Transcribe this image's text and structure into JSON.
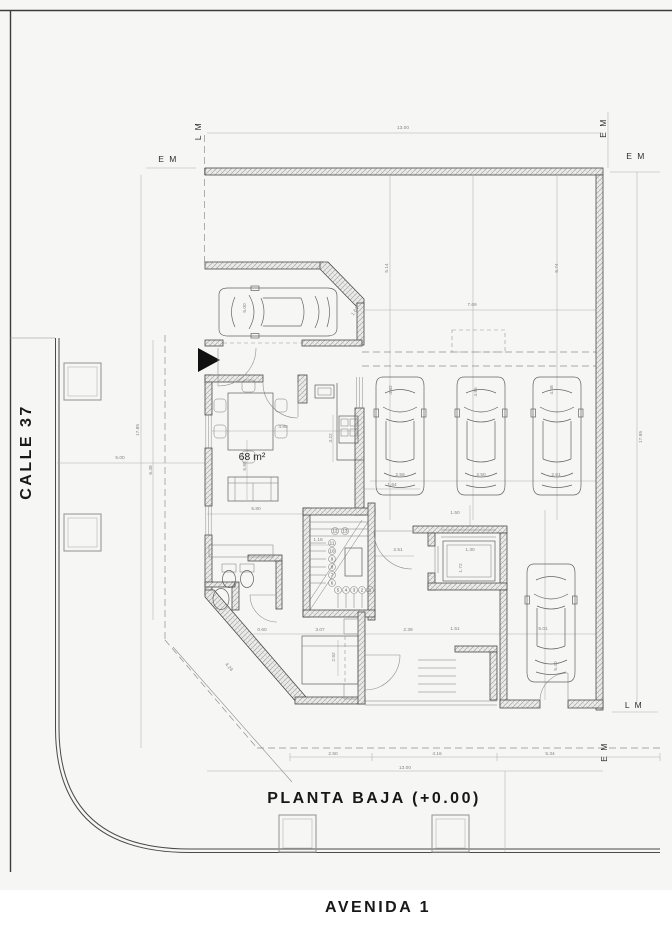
{
  "sheet": {
    "title": "PLANTA BAJA (+0.00)",
    "street_left": "CALLE 37",
    "street_bottom": "AVENIDA 1",
    "area_label": "68 m²"
  },
  "colors": {
    "paper": "#f6f6f4",
    "wall_line": "#4a4a4a",
    "dim_line": "#b0b0b0",
    "text": "#181818"
  },
  "markers": [
    {
      "text": "L M",
      "x": 201,
      "y": 131,
      "rot": -90
    },
    {
      "text": "E M",
      "x": 168,
      "y": 162
    },
    {
      "text": "E M",
      "x": 606,
      "y": 128,
      "rot": -90
    },
    {
      "text": "E M",
      "x": 636,
      "y": 159
    },
    {
      "text": "L M",
      "x": 634,
      "y": 708
    },
    {
      "text": "E M",
      "x": 607,
      "y": 752,
      "rot": -90
    }
  ],
  "dimensions": [
    {
      "text": "13.00",
      "x": 403,
      "y": 129
    },
    {
      "text": "17.95",
      "x": 642,
      "y": 437,
      "rot": -90
    },
    {
      "text": "17.85",
      "x": 139,
      "y": 430,
      "rot": -90
    },
    {
      "text": "6.49",
      "x": 152,
      "y": 470,
      "rot": -90
    },
    {
      "text": "5.00",
      "x": 120,
      "y": 459
    },
    {
      "text": "5.14",
      "x": 388,
      "y": 268,
      "rot": -90
    },
    {
      "text": "5.74",
      "x": 558,
      "y": 268,
      "rot": -90
    },
    {
      "text": "7.69",
      "x": 472,
      "y": 306
    },
    {
      "text": "4.92",
      "x": 392,
      "y": 390,
      "rot": -90
    },
    {
      "text": "4.95",
      "x": 477,
      "y": 392,
      "rot": -90
    },
    {
      "text": "4.68",
      "x": 553,
      "y": 390,
      "rot": -90
    },
    {
      "text": "2.59",
      "x": 400,
      "y": 476
    },
    {
      "text": "2.50",
      "x": 481,
      "y": 476
    },
    {
      "text": "2.61",
      "x": 556,
      "y": 476
    },
    {
      "text": "5.00",
      "x": 246,
      "y": 308,
      "rot": -90
    },
    {
      "text": "1.63",
      "x": 356,
      "y": 312,
      "rot": -55
    },
    {
      "text": "4.80",
      "x": 283,
      "y": 428
    },
    {
      "text": "3.22",
      "x": 332,
      "y": 438,
      "rot": -90
    },
    {
      "text": "5.98",
      "x": 246,
      "y": 466,
      "rot": -90
    },
    {
      "text": "5.80",
      "x": 256,
      "y": 510
    },
    {
      "text": "1.64",
      "x": 392,
      "y": 486
    },
    {
      "text": "1.18",
      "x": 318,
      "y": 541
    },
    {
      "text": "2.51",
      "x": 398,
      "y": 551
    },
    {
      "text": "1.50",
      "x": 455,
      "y": 514
    },
    {
      "text": "1.30",
      "x": 470,
      "y": 551
    },
    {
      "text": "1.72",
      "x": 462,
      "y": 568,
      "rot": -90
    },
    {
      "text": "0.60",
      "x": 262,
      "y": 631
    },
    {
      "text": "3.07",
      "x": 320,
      "y": 631
    },
    {
      "text": "2.92",
      "x": 335,
      "y": 657,
      "rot": -90
    },
    {
      "text": "2.39",
      "x": 408,
      "y": 631
    },
    {
      "text": "1.51",
      "x": 455,
      "y": 630
    },
    {
      "text": "5.01",
      "x": 543,
      "y": 630
    },
    {
      "text": "5.40",
      "x": 557,
      "y": 666,
      "rot": -90
    },
    {
      "text": "4.24",
      "x": 228,
      "y": 668,
      "rot": 49
    },
    {
      "text": "2.50",
      "x": 333,
      "y": 755
    },
    {
      "text": "4.16",
      "x": 437,
      "y": 755
    },
    {
      "text": "5.34",
      "x": 550,
      "y": 755
    },
    {
      "text": "13.00",
      "x": 405,
      "y": 769
    }
  ],
  "stair_steps": [
    {
      "n": "13",
      "x": 345,
      "y": 531
    },
    {
      "n": "12",
      "x": 335,
      "y": 531
    },
    {
      "n": "11",
      "x": 332,
      "y": 543
    },
    {
      "n": "10",
      "x": 332,
      "y": 551
    },
    {
      "n": "9",
      "x": 332,
      "y": 559
    },
    {
      "n": "8",
      "x": 332,
      "y": 567
    },
    {
      "n": "7",
      "x": 332,
      "y": 575
    },
    {
      "n": "6",
      "x": 332,
      "y": 583
    },
    {
      "n": "5",
      "x": 338,
      "y": 590
    },
    {
      "n": "4",
      "x": 346,
      "y": 590
    },
    {
      "n": "3",
      "x": 354,
      "y": 590
    },
    {
      "n": "2",
      "x": 362,
      "y": 590
    },
    {
      "n": "1",
      "x": 370,
      "y": 590
    }
  ]
}
